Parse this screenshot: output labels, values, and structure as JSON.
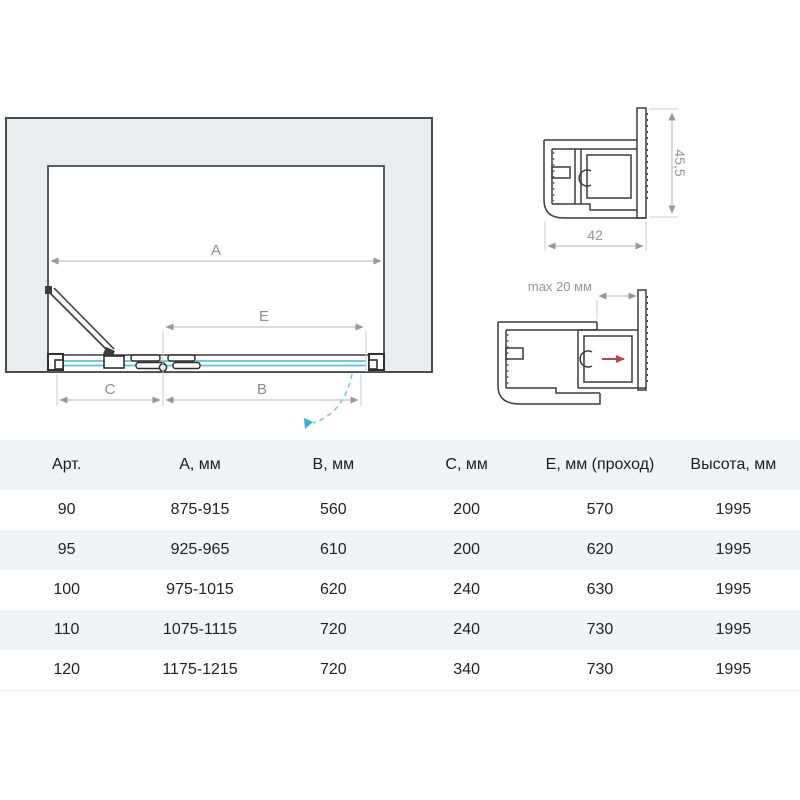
{
  "colors": {
    "wall_gray": "#ebecee",
    "outline_dark": "#3b3c3e",
    "glass_teal": "#5fc3d8",
    "swing_arc_teal": "#7ccbdc",
    "swing_arrow_teal": "#2fb2cd",
    "slide_arrow_red": "#b5484d",
    "dimension_gray": "#b4b5b8",
    "label_gray": "#8c8d91",
    "table_stripe": "#f2f3f7"
  },
  "diagram": {
    "plan": {
      "dim_a": "A",
      "dim_e": "E",
      "dim_c": "C",
      "dim_b": "B"
    },
    "profile_top": {
      "height_label": "45,5",
      "width_label": "42"
    },
    "profile_bottom": {
      "gap_label": "max 20 мм"
    }
  },
  "table": {
    "headers": [
      "Арт.",
      "А, мм",
      "В, мм",
      "С, мм",
      "Е, мм (проход)",
      "Высота, мм"
    ],
    "rows": [
      [
        "90",
        "875-915",
        "560",
        "200",
        "570",
        "1995"
      ],
      [
        "95",
        "925-965",
        "610",
        "200",
        "620",
        "1995"
      ],
      [
        "100",
        "975-1015",
        "620",
        "240",
        "630",
        "1995"
      ],
      [
        "110",
        "1075-1115",
        "720",
        "240",
        "730",
        "1995"
      ],
      [
        "120",
        "1175-1215",
        "720",
        "340",
        "730",
        "1995"
      ]
    ]
  }
}
